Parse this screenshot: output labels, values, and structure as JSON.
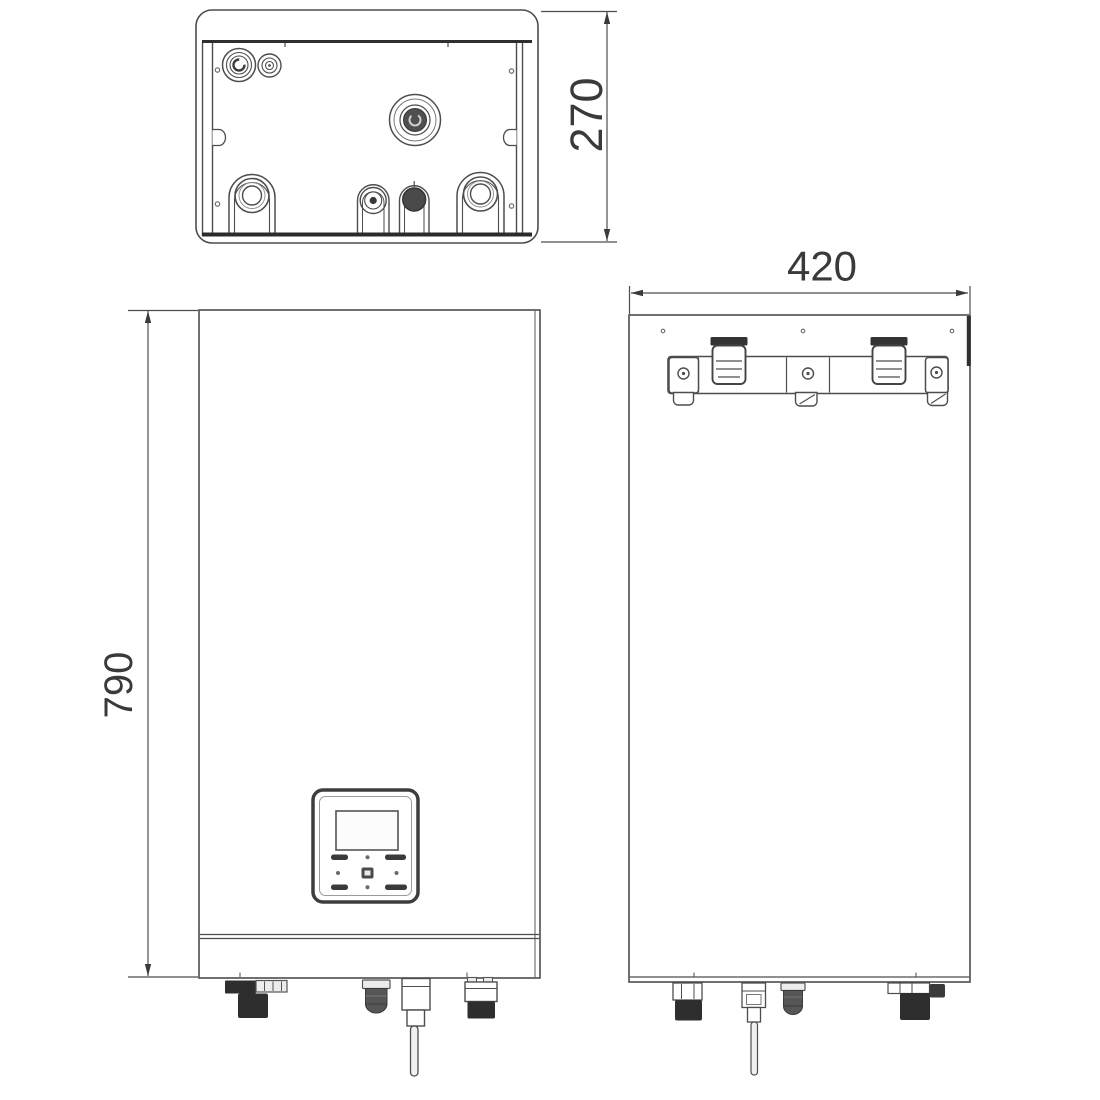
{
  "drawing": {
    "kind": "technical-dimension-drawing",
    "views": {
      "top_view": "top view with pipe connections",
      "front_view": "front view with control panel",
      "back_view": "back view with wall mounting bracket"
    },
    "colors": {
      "background": "#ffffff",
      "line": "#4d4d4d",
      "heavy_line": "#2b2b2b",
      "dark_fill": "#2e2e2e",
      "text": "#3a3a3a"
    }
  },
  "dimensions": {
    "depth": "270",
    "width": "420",
    "height": "790"
  }
}
